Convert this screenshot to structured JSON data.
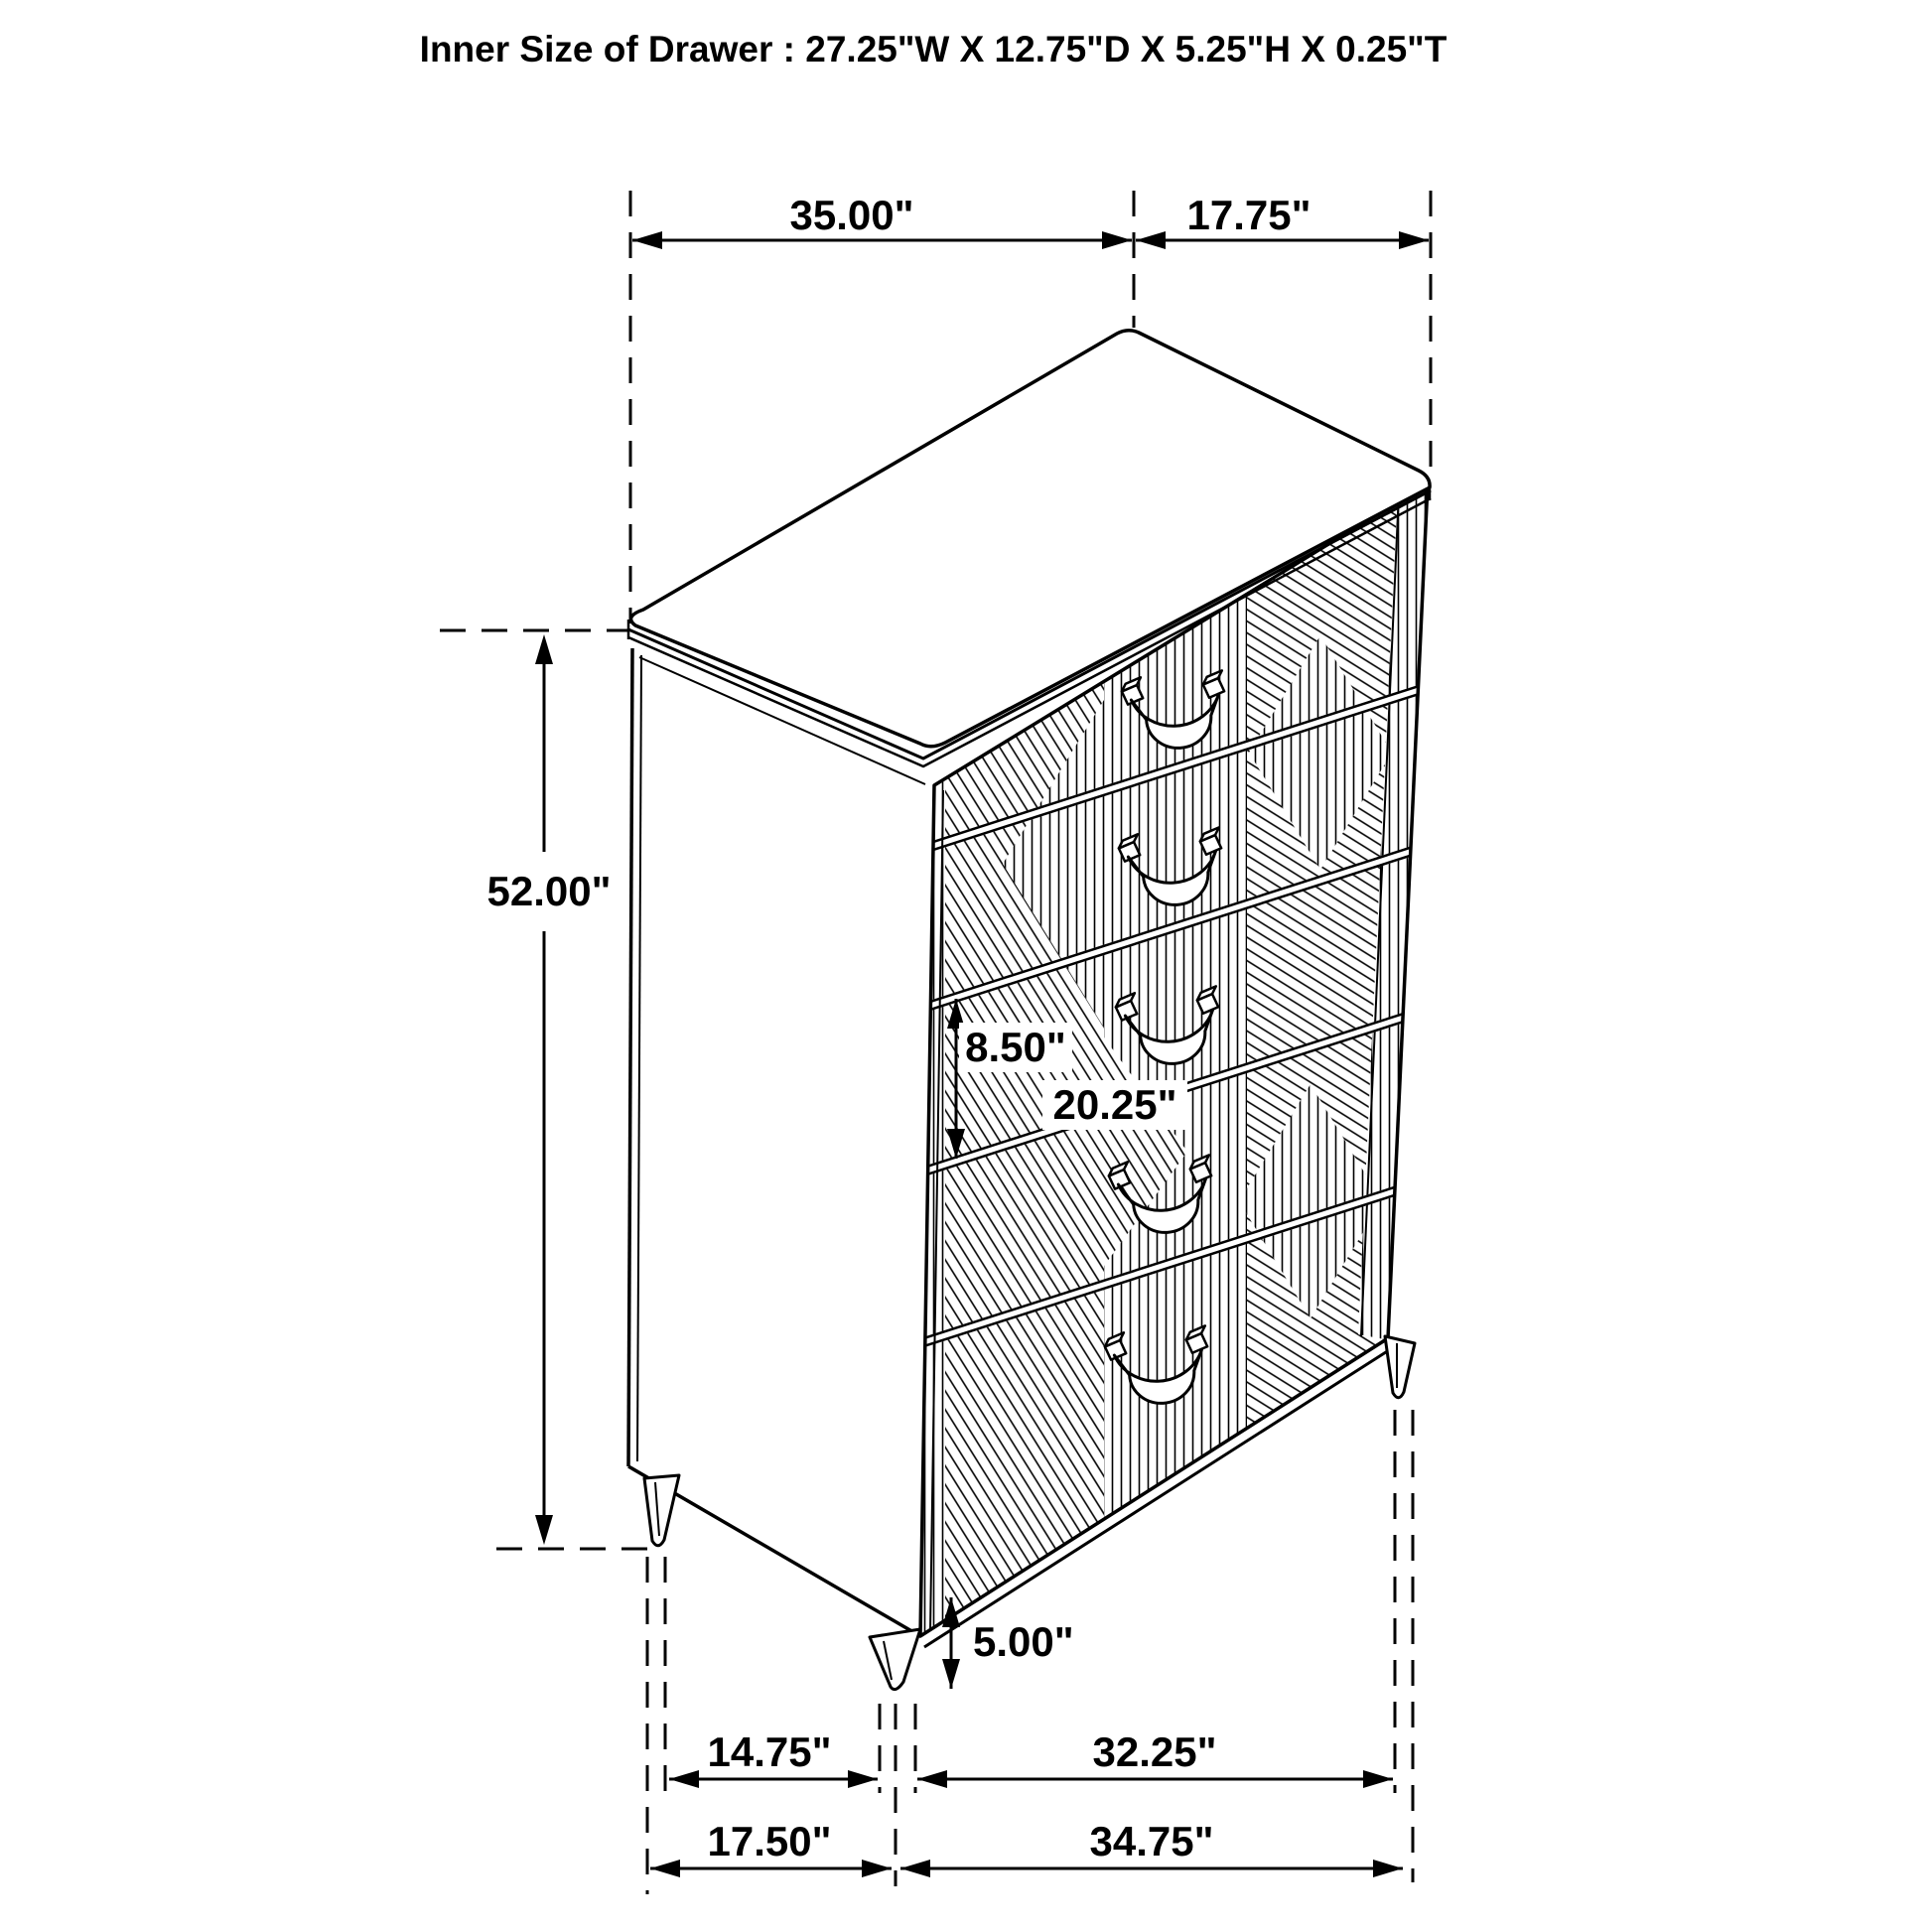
{
  "title": "Inner Size of Drawer : 27.25\"W X 12.75\"D X 5.25\"H X 0.25\"T",
  "dims": {
    "top_width": "35.00\"",
    "top_depth": "17.75\"",
    "height": "52.00\"",
    "drawer_front_height": "8.50\"",
    "drawer_front_width": "20.25\"",
    "leg_height": "5.00\"",
    "bottom_left_inner": "14.75\"",
    "bottom_right_inner": "32.25\"",
    "bottom_left_outer": "17.50\"",
    "bottom_right_outer": "34.75\""
  },
  "colors": {
    "line": "#000000",
    "background": "#ffffff"
  }
}
